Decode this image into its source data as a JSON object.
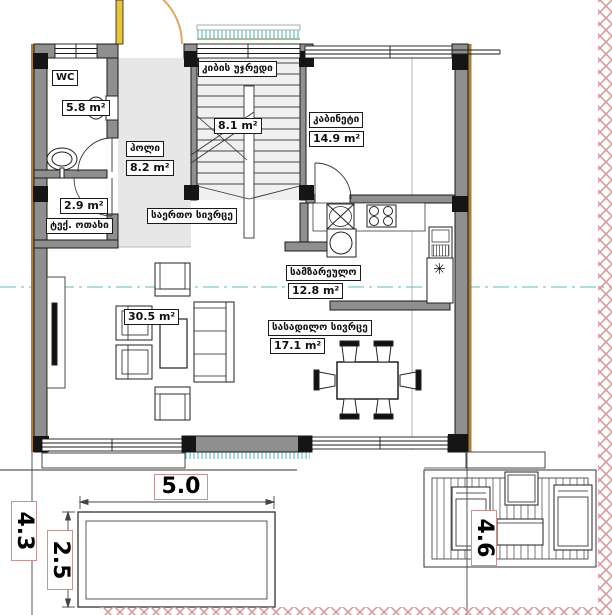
{
  "floor_plan": {
    "rooms": [
      {
        "id": "wc",
        "label": "WC",
        "area": "5.8 m²"
      },
      {
        "id": "hall",
        "label": "ჰოლი",
        "area": "8.2 m²"
      },
      {
        "id": "tech_room",
        "label": "ტექ. ოთახი",
        "area": "2.9 m²"
      },
      {
        "id": "staircase",
        "label": "კიბის უჯრედი",
        "area": "8.1 m²"
      },
      {
        "id": "study",
        "label": "კაბინეტი",
        "area": "14.9 m²"
      },
      {
        "id": "common_space",
        "label": "საერთო სივრცე",
        "area": "30.5 m²"
      },
      {
        "id": "kitchen",
        "label": "სამზარეულო",
        "area": "12.8 m²"
      },
      {
        "id": "dining",
        "label": "სასადილო სივრცე",
        "area": "17.1 m²"
      }
    ],
    "dimensions": {
      "pool_width": "5.0",
      "site_depth": "4.3",
      "pool_depth": "2.5",
      "deck_width": "4.6"
    },
    "symbols": {
      "freezer_asterisk": "✳"
    },
    "colors": {
      "wall": "#8f8f8f",
      "hall_floor": "#e7e7e7",
      "stair_floor": "#f0f0f0",
      "accent_trim": "#a8803a",
      "entrance_arc": "#dfa75f",
      "door_leaf": "#e9c53d",
      "hatch_teal": "#49b3b3",
      "centerline": "#7ccaca",
      "border_zigzag": "#d89090",
      "dim_border": "#c49393",
      "column": "#151515"
    }
  }
}
